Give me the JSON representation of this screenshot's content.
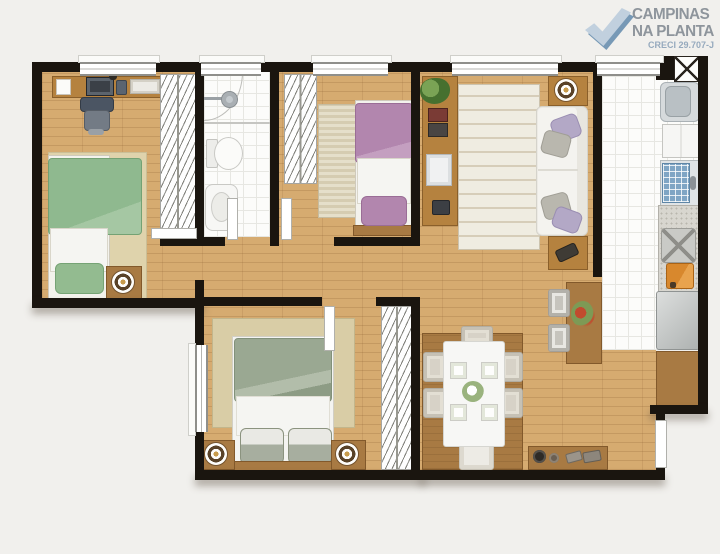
{
  "logo": {
    "line1": "CAMPINAS",
    "line2": "NA PLANTA",
    "creci": "CRECI 29.707-J",
    "icon": "check-icon",
    "colors": {
      "icon_light": "#c1d0de",
      "icon_dark": "#628aac",
      "text": "#7d858d",
      "creci": "#8ca2b8"
    }
  },
  "palette": {
    "wall": "#1a150f",
    "wood_floor": "#d6ab70",
    "tile_floor": "#fcfcfa",
    "rug_beige": "#ddd0aa",
    "bed_green": "#8fb98f",
    "bed_purple": "#b286ae",
    "bed_master_sage": "#9aa892",
    "furniture_wood": "#b5823f",
    "cabinet_wood": "#a87a43",
    "sofa_white": "#f4f3ef",
    "sink_rack_blue": "#7fa5c4",
    "cutting_board_orange": "#d8882d"
  },
  "plan": {
    "type": "apartment-floor-plan",
    "rooms": [
      {
        "name": "bedroom-1",
        "items": [
          "desk",
          "monitor",
          "keyboard",
          "phone",
          "paper",
          "office-chair",
          "wardrobe",
          "rug",
          "single-bed-green",
          "pillow",
          "nightstand",
          "table-lamp"
        ]
      },
      {
        "name": "bathroom",
        "items": [
          "shower",
          "shower-head",
          "toilet",
          "sink"
        ]
      },
      {
        "name": "bedroom-2",
        "items": [
          "wardrobe",
          "striped-rug",
          "single-bed-purple",
          "pillow"
        ]
      },
      {
        "name": "living-room",
        "items": [
          "tv-stand",
          "plant",
          "picture-frames",
          "tv",
          "speaker",
          "striped-rug",
          "sofa",
          "cushions",
          "side-table-top",
          "side-table-bottom",
          "table-lamp",
          "remote"
        ]
      },
      {
        "name": "kitchen-service",
        "items": [
          "duct-shaft",
          "washing-machine",
          "cabinet",
          "sink-with-dish-rack",
          "faucet",
          "granite-counter",
          "cooktop",
          "cutting-board",
          "refrigerator",
          "lower-cabinet"
        ]
      },
      {
        "name": "hallway",
        "items": []
      },
      {
        "name": "master-bedroom",
        "items": [
          "window",
          "rug",
          "double-bed",
          "pillows",
          "headboard",
          "nightstand-left",
          "nightstand-right",
          "table-lamps",
          "wardrobe"
        ]
      },
      {
        "name": "dining-room",
        "items": [
          "wood-mat",
          "dining-table",
          "plates",
          "flower-centerpiece",
          "chairs",
          "sideboard",
          "decor-objects",
          "bar-counter",
          "bar-chairs",
          "flower-vase",
          "entry-door"
        ]
      }
    ],
    "openings": [
      "bedroom-1-door",
      "bathroom-door",
      "bedroom-2-door",
      "master-bedroom-door",
      "entry-door",
      "5-windows-top",
      "master-window"
    ]
  }
}
